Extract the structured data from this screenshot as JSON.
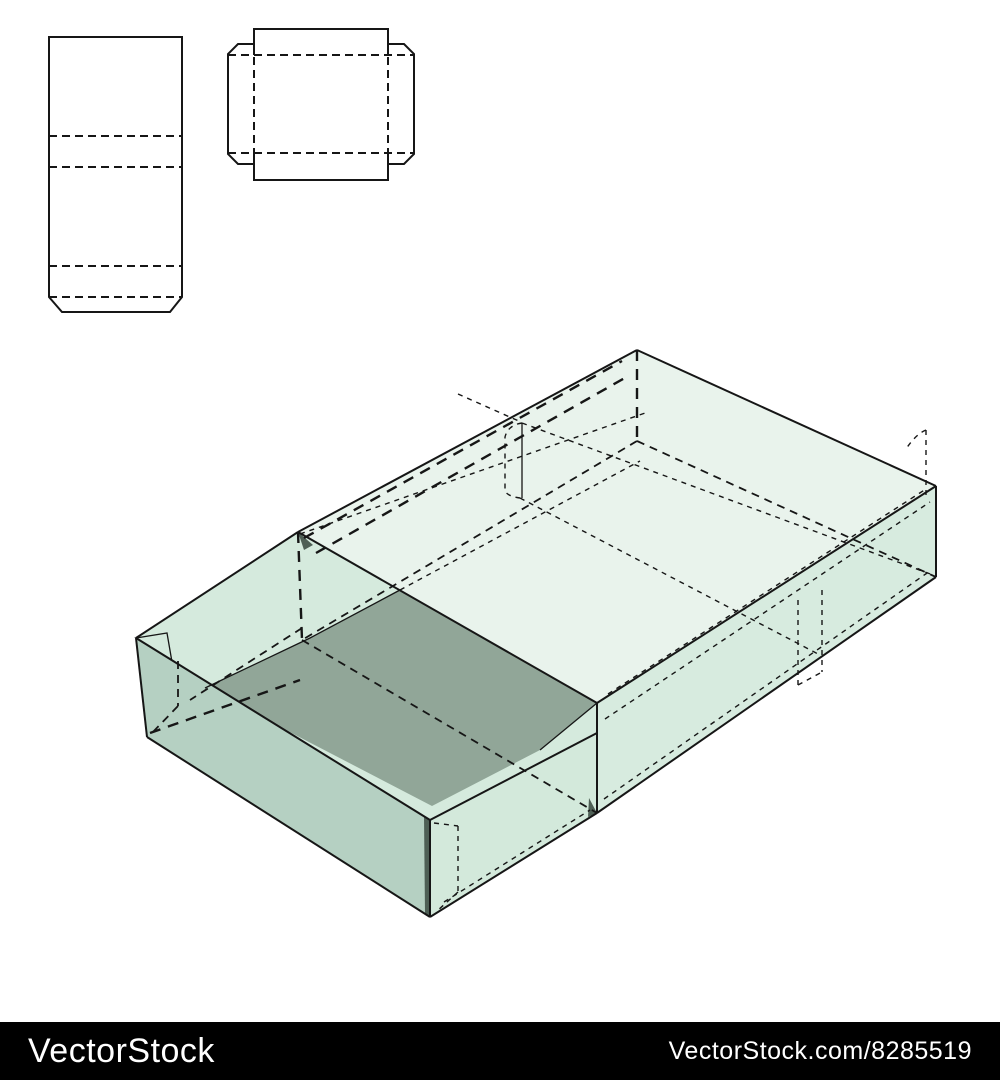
{
  "watermark": {
    "brand": "VectorStock",
    "credit": "VectorStock.com/8285519"
  },
  "figure": {
    "description_labels": {
      "template_sleeve": "sleeve die-cut template",
      "template_tray": "tray die-cut template",
      "box_3d": "3d sleeve and tray box"
    }
  },
  "colors": {
    "canvas": "#ffffff",
    "line": "#161616",
    "sleeve_top": "#e9f3ec",
    "sleeve_front": "#d7ebdf",
    "tray_inner": "#d5eadd",
    "tray_floor": "#91a698",
    "tray_end": "#b5d0c2",
    "tray_side": "#d3e9db",
    "sliver": "#4e5f55",
    "bar_bg": "#000000",
    "bar_text": "#ffffff"
  }
}
